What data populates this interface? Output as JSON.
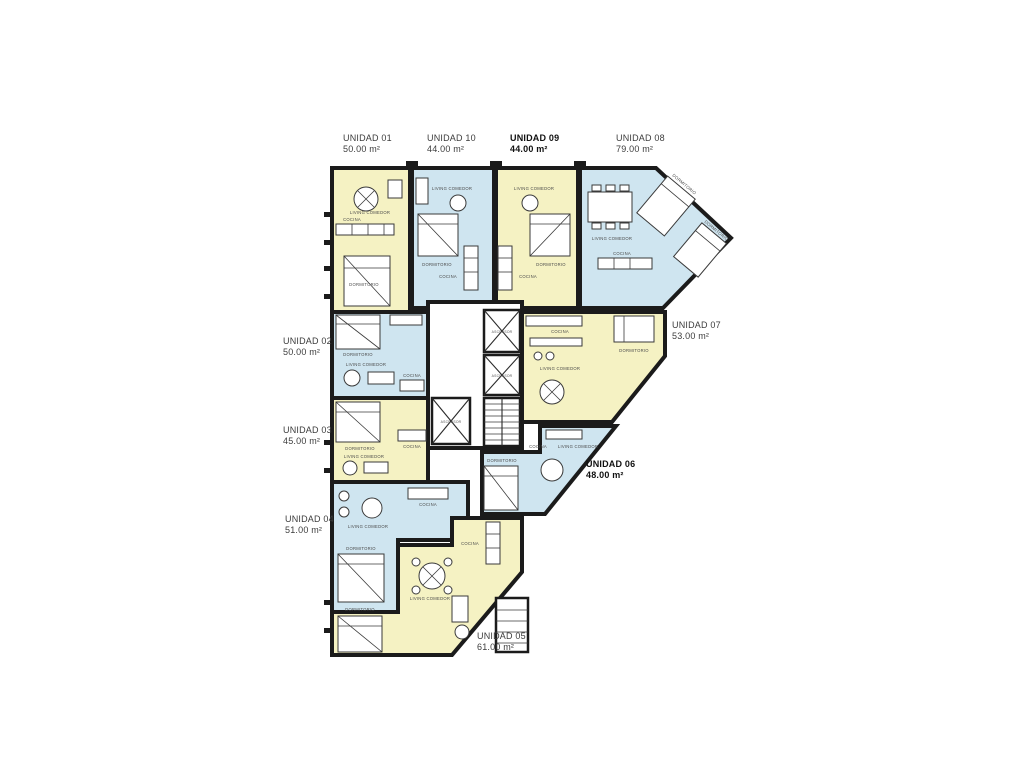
{
  "document": {
    "type": "apartment-floor-plan",
    "background": "#ffffff"
  },
  "colors": {
    "unit_fill_yellow": "#f5f2c3",
    "unit_fill_blue": "#cfe5f0",
    "wall": "#1b1b1b",
    "furniture_line": "#3a3a3a",
    "label_text": "#3c3c3c"
  },
  "units": [
    {
      "id": "unidad-01",
      "name": "UNIDAD 01",
      "area": "50.00 m²",
      "fill": "yellow",
      "bold": false
    },
    {
      "id": "unidad-02",
      "name": "UNIDAD 02",
      "area": "50.00 m²",
      "fill": "blue",
      "bold": false
    },
    {
      "id": "unidad-03",
      "name": "UNIDAD 03",
      "area": "45.00 m²",
      "fill": "yellow",
      "bold": false
    },
    {
      "id": "unidad-04",
      "name": "UNIDAD 04",
      "area": "51.00 m²",
      "fill": "blue",
      "bold": false
    },
    {
      "id": "unidad-05",
      "name": "UNIDAD 05",
      "area": "61.00 m²",
      "fill": "yellow",
      "bold": false
    },
    {
      "id": "unidad-06",
      "name": "UNIDAD 06",
      "area": "48.00 m²",
      "fill": "blue",
      "bold": true
    },
    {
      "id": "unidad-07",
      "name": "UNIDAD 07",
      "area": "53.00 m²",
      "fill": "yellow",
      "bold": false
    },
    {
      "id": "unidad-08",
      "name": "UNIDAD 08",
      "area": "79.00 m²",
      "fill": "blue",
      "bold": false
    },
    {
      "id": "unidad-09",
      "name": "UNIDAD 09",
      "area": "44.00 m²",
      "fill": "yellow",
      "bold": true
    },
    {
      "id": "unidad-10",
      "name": "UNIDAD 10",
      "area": "44.00 m²",
      "fill": "blue",
      "bold": false
    }
  ],
  "rooms": {
    "living": "LIVING COMEDOR",
    "bedroom": "DORMITORIO",
    "kitchen": "COCINA",
    "elevator": "ASCENSOR"
  }
}
